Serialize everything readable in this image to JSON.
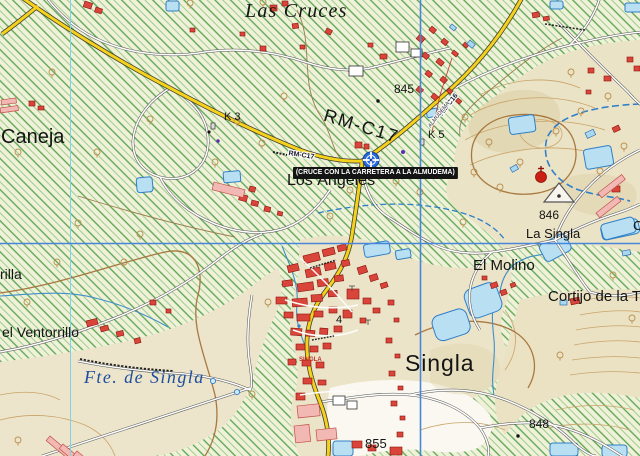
{
  "map_title": "Topographic map of Singla area",
  "colors": {
    "road_primary_yellow": "#f6d11c",
    "road_secondary_white": "#fdfdfb",
    "water_fill": "#b9e0f2",
    "water_line": "#2f7fc9",
    "building_red": "#d9453a",
    "building_outline": "#8b150c",
    "building_pink": "#f2b8b4",
    "hatch_green": "#57a34f",
    "contour_tan": "#c9a368",
    "contour_index_brown": "#a87840",
    "grid_cyan": "#7ed3e0",
    "grid_blue": "#4a86d8",
    "banner_bg": "#141414",
    "banner_text": "#ffffff",
    "marker_blue": "#2a6ae0",
    "label_water_blue": "#1d4e9e",
    "label_street_red": "#c03028"
  },
  "annotation": {
    "text": "(CRUCE CON LA CARRETERA A LA ALMUDEMA)"
  },
  "marker": {
    "name": "junction-marker",
    "type": "crosshair",
    "x": 371,
    "y": 160
  },
  "labels": [
    {
      "name": "label-las-cruces",
      "text": "Las Cruces",
      "x": 245,
      "y": 1,
      "size": 20,
      "class": "serifi",
      "spacing": 0.06
    },
    {
      "name": "label-caneja",
      "text": "Caneja",
      "x": 1,
      "y": 127,
      "size": 20,
      "weight": 500
    },
    {
      "name": "label-k3",
      "text": "K 3",
      "x": 224,
      "y": 112,
      "size": 11
    },
    {
      "name": "label-845",
      "text": "845",
      "x": 394,
      "y": 83,
      "size": 12
    },
    {
      "name": "label-rm-c17",
      "text": "RM-C17",
      "x": 327,
      "y": 106,
      "size": 18,
      "rot": 17,
      "spacing": 0.1,
      "weight": 500
    },
    {
      "name": "label-rm-c17-shield",
      "text": "RM-C17",
      "x": 289,
      "y": 150,
      "size": 7,
      "rot": 9,
      "weight": 700,
      "class": "halo roadnum"
    },
    {
      "name": "label-k5",
      "text": "K 5",
      "x": 428,
      "y": 130,
      "size": 11
    },
    {
      "name": "label-rm-c16-shield",
      "text": "RM-C16",
      "x": 438,
      "y": 113,
      "size": 7,
      "rot": -52,
      "weight": 700,
      "class": "halo roadnum"
    },
    {
      "name": "label-almudema",
      "text": "ALMUDEMA",
      "x": 428,
      "y": 126,
      "size": 5.5,
      "rot": -52,
      "class": "halo micro"
    },
    {
      "name": "label-los-angeles",
      "text": "Los Ángeles",
      "x": 287,
      "y": 173,
      "size": 16,
      "weight": 500
    },
    {
      "name": "label-la-singla",
      "text": "La Singla",
      "x": 526,
      "y": 227,
      "size": 13,
      "weight": 500
    },
    {
      "name": "label-846",
      "text": "846",
      "x": 539,
      "y": 209,
      "size": 12
    },
    {
      "name": "label-el-molino",
      "text": "El Molino",
      "x": 473,
      "y": 258,
      "size": 15,
      "weight": 500
    },
    {
      "name": "label-cortijo",
      "text": "Cortijo de la T",
      "x": 548,
      "y": 289,
      "size": 15,
      "weight": 500
    },
    {
      "name": "label-singla",
      "text": "Singla",
      "x": 405,
      "y": 352,
      "size": 23,
      "weight": 500,
      "spacing": 0.04
    },
    {
      "name": "label-singla-street",
      "text": "SINGLA",
      "x": 299,
      "y": 357,
      "size": 6,
      "weight": 700,
      "class": "red"
    },
    {
      "name": "label-parcel-4",
      "text": "4",
      "x": 336,
      "y": 315,
      "size": 11
    },
    {
      "name": "label-848",
      "text": "848",
      "x": 529,
      "y": 418,
      "size": 12
    },
    {
      "name": "label-855",
      "text": "855",
      "x": 365,
      "y": 437,
      "size": 13
    },
    {
      "name": "label-ventorrillo",
      "text": "el Ventorrillo",
      "x": 2,
      "y": 325,
      "size": 14,
      "weight": 500
    },
    {
      "name": "label-rilla",
      "text": "rilla",
      "x": 0,
      "y": 267,
      "size": 14,
      "weight": 500
    },
    {
      "name": "label-fte-de-singla",
      "text": "Fte. de Singla",
      "x": 84,
      "y": 368,
      "size": 18,
      "class": "serifi blue",
      "spacing": 0.08
    },
    {
      "name": "label-cut-right-edge",
      "text": "C",
      "x": 633,
      "y": 219,
      "size": 13,
      "weight": 500
    }
  ]
}
